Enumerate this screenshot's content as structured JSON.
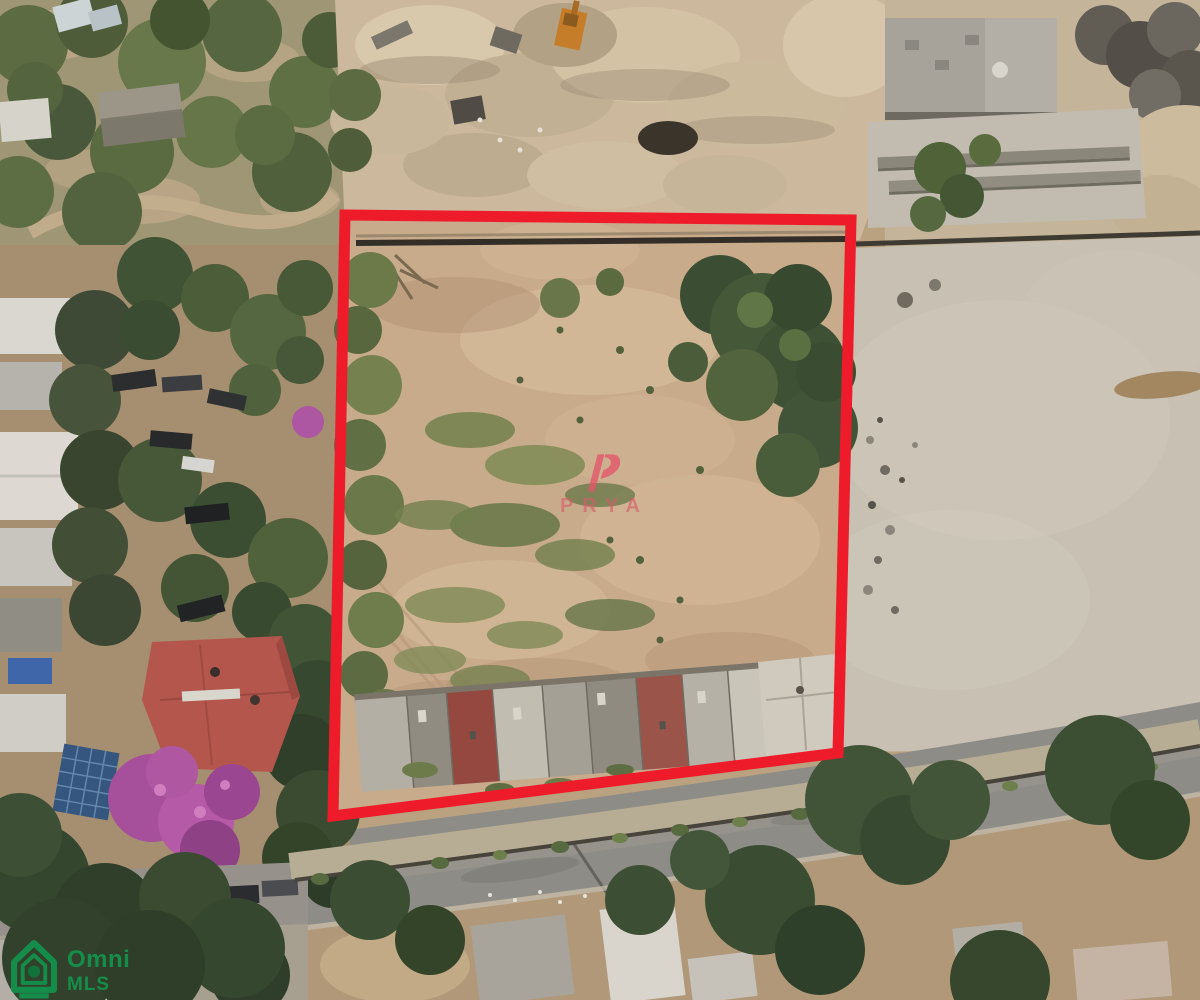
{
  "watermark": {
    "brand": "PRYA",
    "color": "#d65c68"
  },
  "corner_logo": {
    "line1": "Omni",
    "line2": "MLS",
    "color": "#12984f"
  },
  "boundary": {
    "color": "#ee1c2b",
    "stroke_width": "11",
    "points": "345,215 851,220 838,753 333,816"
  }
}
